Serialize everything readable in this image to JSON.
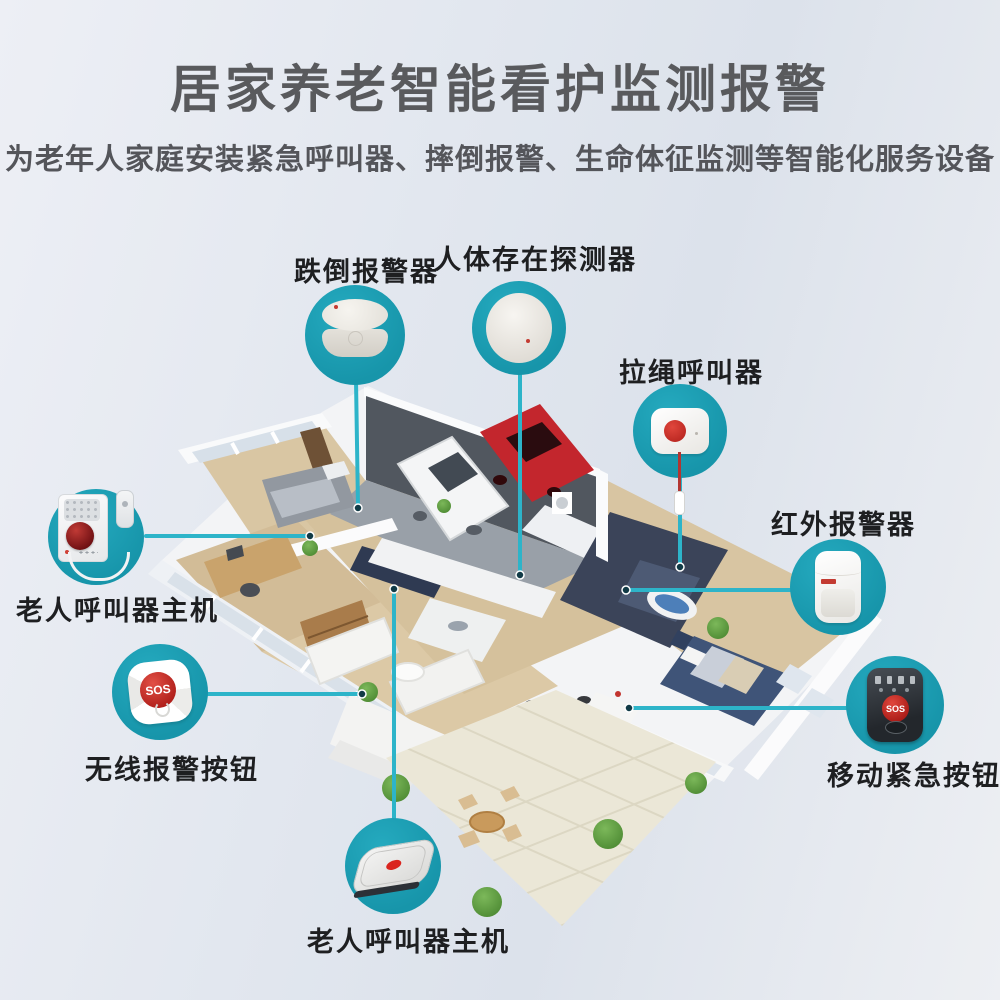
{
  "header": {
    "title": "居家养老智能看护监测报警",
    "subtitle": "为老年人家庭安装紧急呼叫器、摔倒报警、生命体征监测等智能化服务设备"
  },
  "colors": {
    "badge_teal": "#1b9db2",
    "connector_cyan": "#2db4c9",
    "alert_red": "#c33b32",
    "title_gray": "#595a5d"
  },
  "devices": [
    {
      "id": "fall-alarm",
      "label": "跌倒报警器"
    },
    {
      "id": "presence-detector",
      "label": "人体存在探测器"
    },
    {
      "id": "pull-cord-caller",
      "label": "拉绳呼叫器"
    },
    {
      "id": "infrared-alarm",
      "label": "红外报警器"
    },
    {
      "id": "caller-host-left",
      "label": "老人呼叫器主机"
    },
    {
      "id": "wireless-sos-button",
      "label": "无线报警按钮",
      "button_text": "SOS"
    },
    {
      "id": "mobile-emergency-button",
      "label": "移动紧急按钮",
      "button_text": "SOS"
    },
    {
      "id": "caller-host-bottom",
      "label": "老人呼叫器主机"
    }
  ]
}
